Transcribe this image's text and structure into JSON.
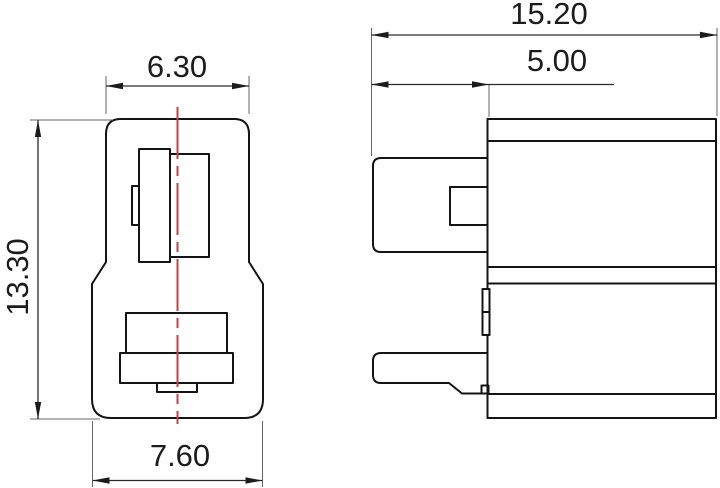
{
  "drawing": {
    "type": "technical-dimension-drawing",
    "views": {
      "front": {
        "name": "front-view",
        "dim_width_top": "6.30",
        "dim_height": "13.30",
        "dim_width_bottom": "7.60"
      },
      "side": {
        "name": "side-view",
        "dim_total_width": "15.20",
        "dim_tab_depth": "5.00"
      }
    },
    "colors": {
      "outline": "#141414",
      "dimension_line": "#2a2a2a",
      "extension_line": "#666666",
      "centerline": "#c64040",
      "text": "#1c1c1c",
      "background": "#ffffff"
    }
  }
}
